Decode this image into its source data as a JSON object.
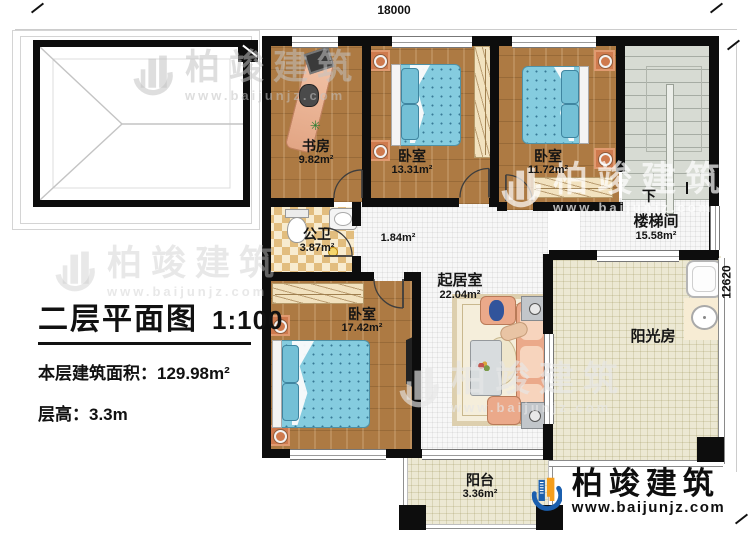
{
  "plan": {
    "title": "二层平面图",
    "scale": "1:100",
    "floor_area_label": "本层建筑面积：",
    "floor_area_value": "129.98m²",
    "floor_height_label": "层高：",
    "floor_height_value": "3.3m"
  },
  "dimensions": {
    "width": "18000",
    "depth": "12620"
  },
  "rooms": {
    "study": {
      "name": "书房",
      "area": "9.82m²"
    },
    "bedroom1": {
      "name": "卧室",
      "area": "13.31m²"
    },
    "bedroom2": {
      "name": "卧室",
      "area": "11.72m²"
    },
    "bedroom3": {
      "name": "卧室",
      "area": "17.42m²"
    },
    "bathroom": {
      "name": "公卫",
      "area": "3.87m²"
    },
    "corridor": {
      "area": "1.84m²"
    },
    "living": {
      "name": "起居室",
      "area": "22.04m²"
    },
    "stairwell": {
      "name": "楼梯间",
      "area": "15.58m²",
      "down": "下"
    },
    "sunroom": {
      "name": "阳光房"
    },
    "balcony": {
      "name": "阳台",
      "area": "3.36m²"
    }
  },
  "branding": {
    "company": "柏竣建筑",
    "website": "www.baijunjz.com"
  },
  "icons": {
    "plant": "✳"
  },
  "colors": {
    "wall": "#0d0d0d",
    "logo_blue": "#1b5fae",
    "logo_orange": "#f59e1d",
    "bed_blue": "#85ccdf"
  }
}
